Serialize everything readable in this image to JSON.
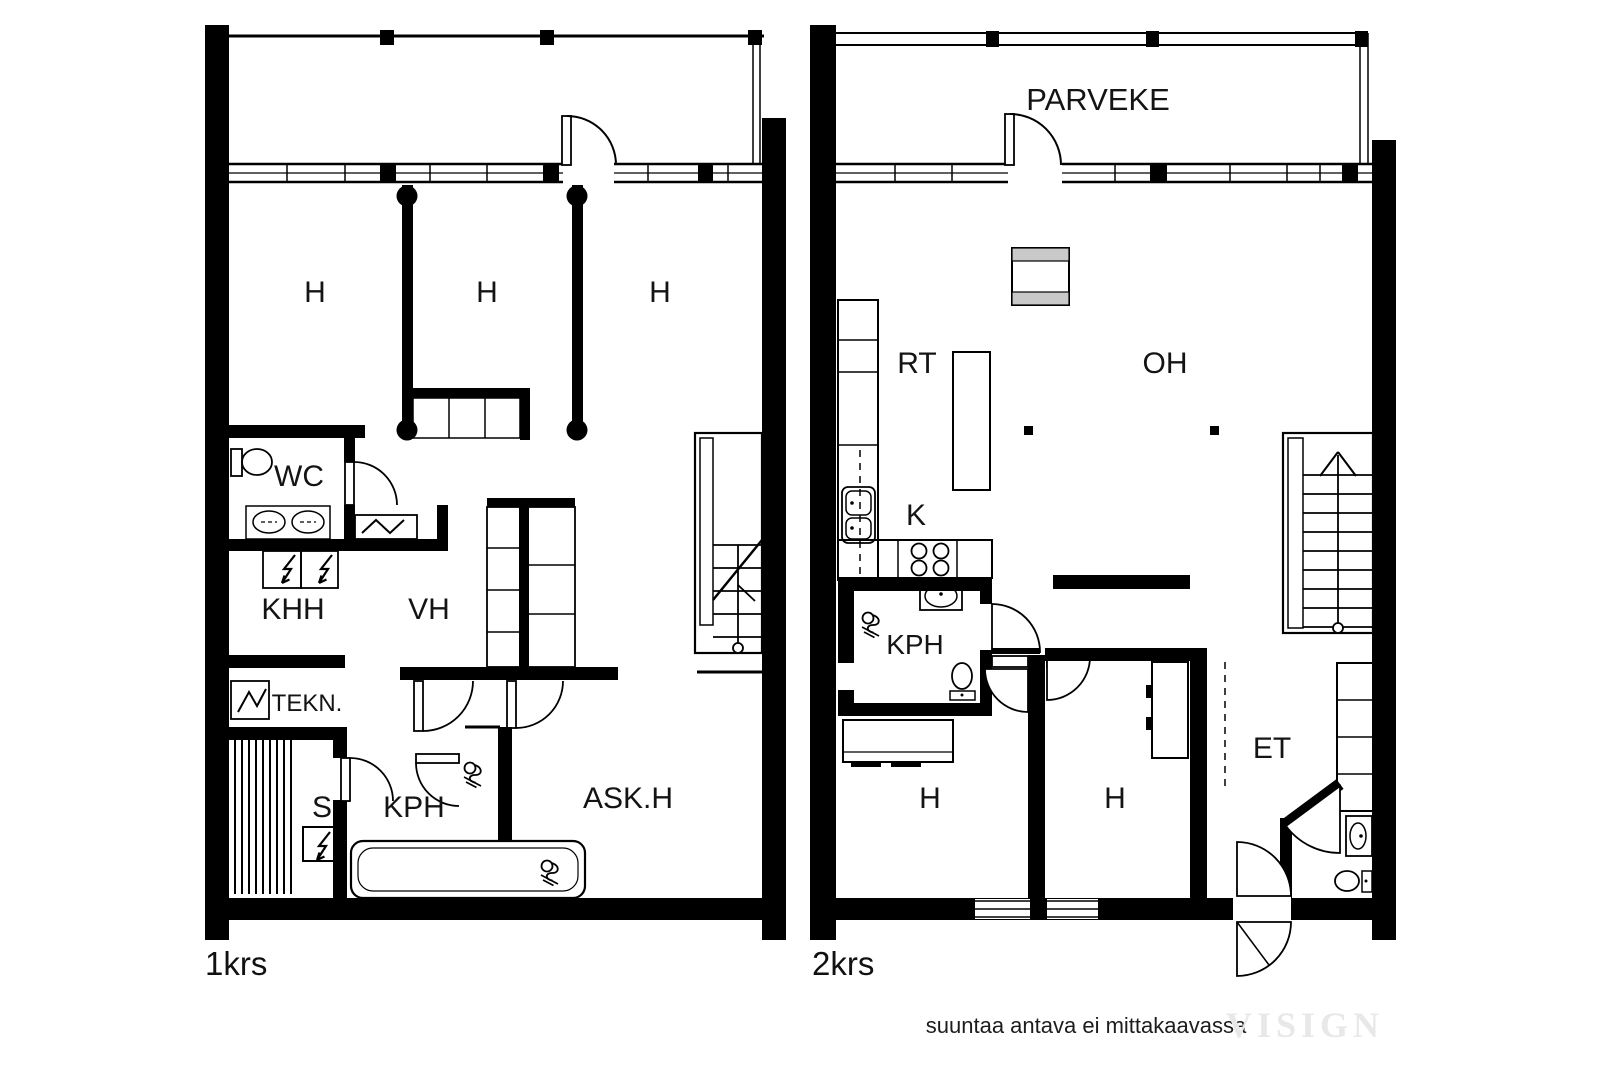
{
  "plan1": {
    "floor_label": "1krs",
    "rooms": {
      "h1": "H",
      "h2": "H",
      "h3": "H",
      "wc": "WC",
      "khh": "KHH",
      "vh": "VH",
      "tekn": "TEKN.",
      "s": "S",
      "kph": "KPH",
      "askh": "ASK.H"
    }
  },
  "plan2": {
    "floor_label": "2krs",
    "rooms": {
      "parveke": "PARVEKE",
      "rt": "RT",
      "oh": "OH",
      "k": "K",
      "kph": "KPH",
      "h1": "H",
      "h2": "H",
      "et": "ET"
    }
  },
  "footer": {
    "disclaimer": "suuntaa antava ei mittakaavassa",
    "watermark": "VISIGN"
  },
  "colors": {
    "wall": "#000000",
    "fireplace_hatch": "#c9c9c9",
    "watermark": "#e8e8e8"
  }
}
